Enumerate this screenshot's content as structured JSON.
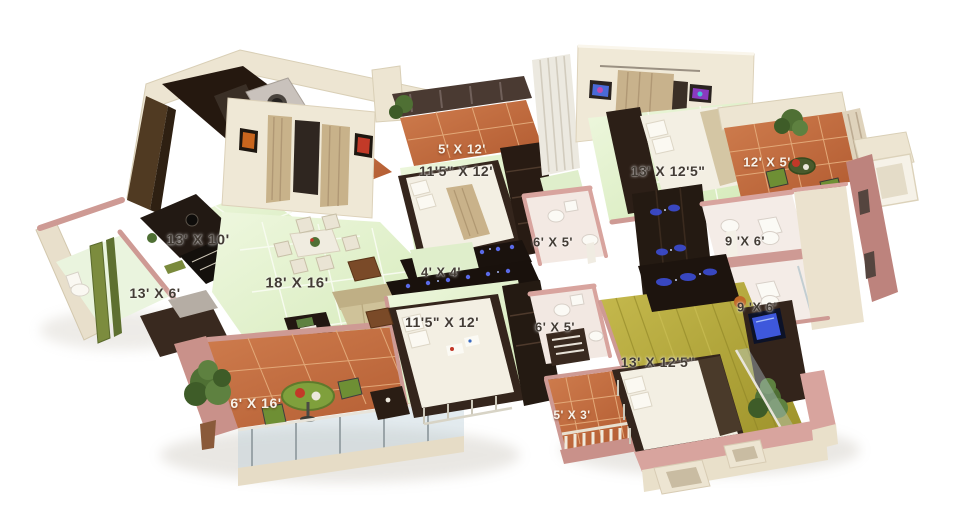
{
  "scene": {
    "type": "3d-isometric-apartment-floor-plan",
    "background": "#ffffff"
  },
  "palette": {
    "floor_green": "#e3f2ce",
    "floor_terracotta": "#c36a3e",
    "floor_wood": "#b5aa3c",
    "wall_cream": "#ede5d2",
    "wall_pink": "#ce9a94",
    "furniture_dark": "#2a1d16",
    "label_dark": "#433c35",
    "label_light": "#f7f2e9",
    "accent_blue": "#3c4cd4",
    "plant_green": "#4f7034"
  },
  "rooms": [
    {
      "name": "kitchen",
      "label": "13' X 10'"
    },
    {
      "name": "utility-room",
      "label": "13' X 6'"
    },
    {
      "name": "living-dining",
      "label": "18' X 16'"
    },
    {
      "name": "balcony-bottom-left",
      "label": "6' X 16'"
    },
    {
      "name": "balcony-top-middle",
      "label": "5' X 12'"
    },
    {
      "name": "bedroom-top-middle",
      "label": "11'5\" X 12'"
    },
    {
      "name": "bedroom-top-right",
      "label": "13' X 12'5\""
    },
    {
      "name": "balcony-top-right",
      "label": "12' X 5'"
    },
    {
      "name": "bathroom-top-middle",
      "label": "6' X 5'"
    },
    {
      "name": "passage",
      "label": "4' X 4'"
    },
    {
      "name": "bathroom-right-upper",
      "label": "9 'X 6'"
    },
    {
      "name": "bathroom-right-lower",
      "label": "9 'X 6'"
    },
    {
      "name": "bedroom-bottom-middle",
      "label": "11'5\" X 12'"
    },
    {
      "name": "bathroom-bottom-middle",
      "label": "6' X 5'"
    },
    {
      "name": "balcony-bottom-small",
      "label": "5' X 3'"
    },
    {
      "name": "bedroom-bottom-right",
      "label": "13' X 12'5\""
    }
  ]
}
